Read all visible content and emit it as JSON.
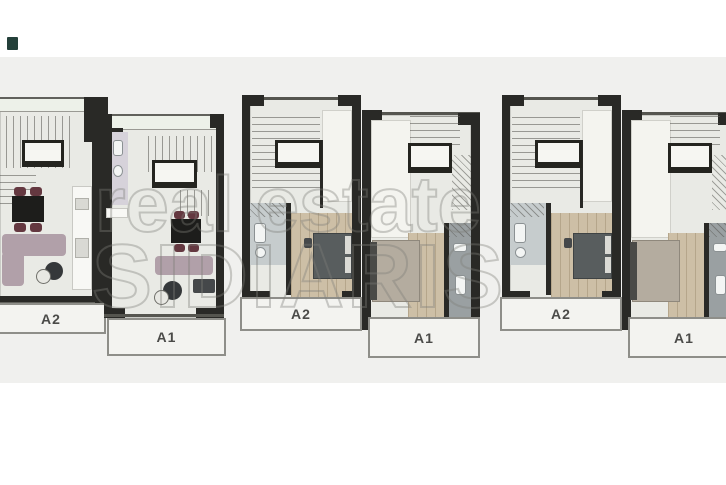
{
  "watermark": {
    "line1": "real estate",
    "line2": "SIDIARIS"
  },
  "groups": [
    {
      "name": "left-building",
      "units": [
        {
          "label": "A2"
        },
        {
          "label": "A1"
        }
      ]
    },
    {
      "name": "middle-building",
      "units": [
        {
          "label": "A2"
        },
        {
          "label": "A1"
        }
      ]
    },
    {
      "name": "right-building",
      "units": [
        {
          "label": "A2"
        },
        {
          "label": "A1"
        }
      ]
    }
  ],
  "colors": {
    "page": "#ffffff",
    "background_band": "#f0f0ee",
    "wall": "#292926",
    "floor": "#e9eae5",
    "wood_floor": "#cdbfa6",
    "bathroom": "#c6cccd",
    "sofa": "#b1a0a9",
    "chair": "#643840",
    "bed_dark": "#585d5e",
    "bed_beige": "#b4ac9f",
    "balcony_fill": "#f3f3f0",
    "balcony_border": "#8e8e89",
    "label_text": "#4b4b49",
    "watermark": "#7d7d78",
    "corner_marker": "#24403a"
  }
}
